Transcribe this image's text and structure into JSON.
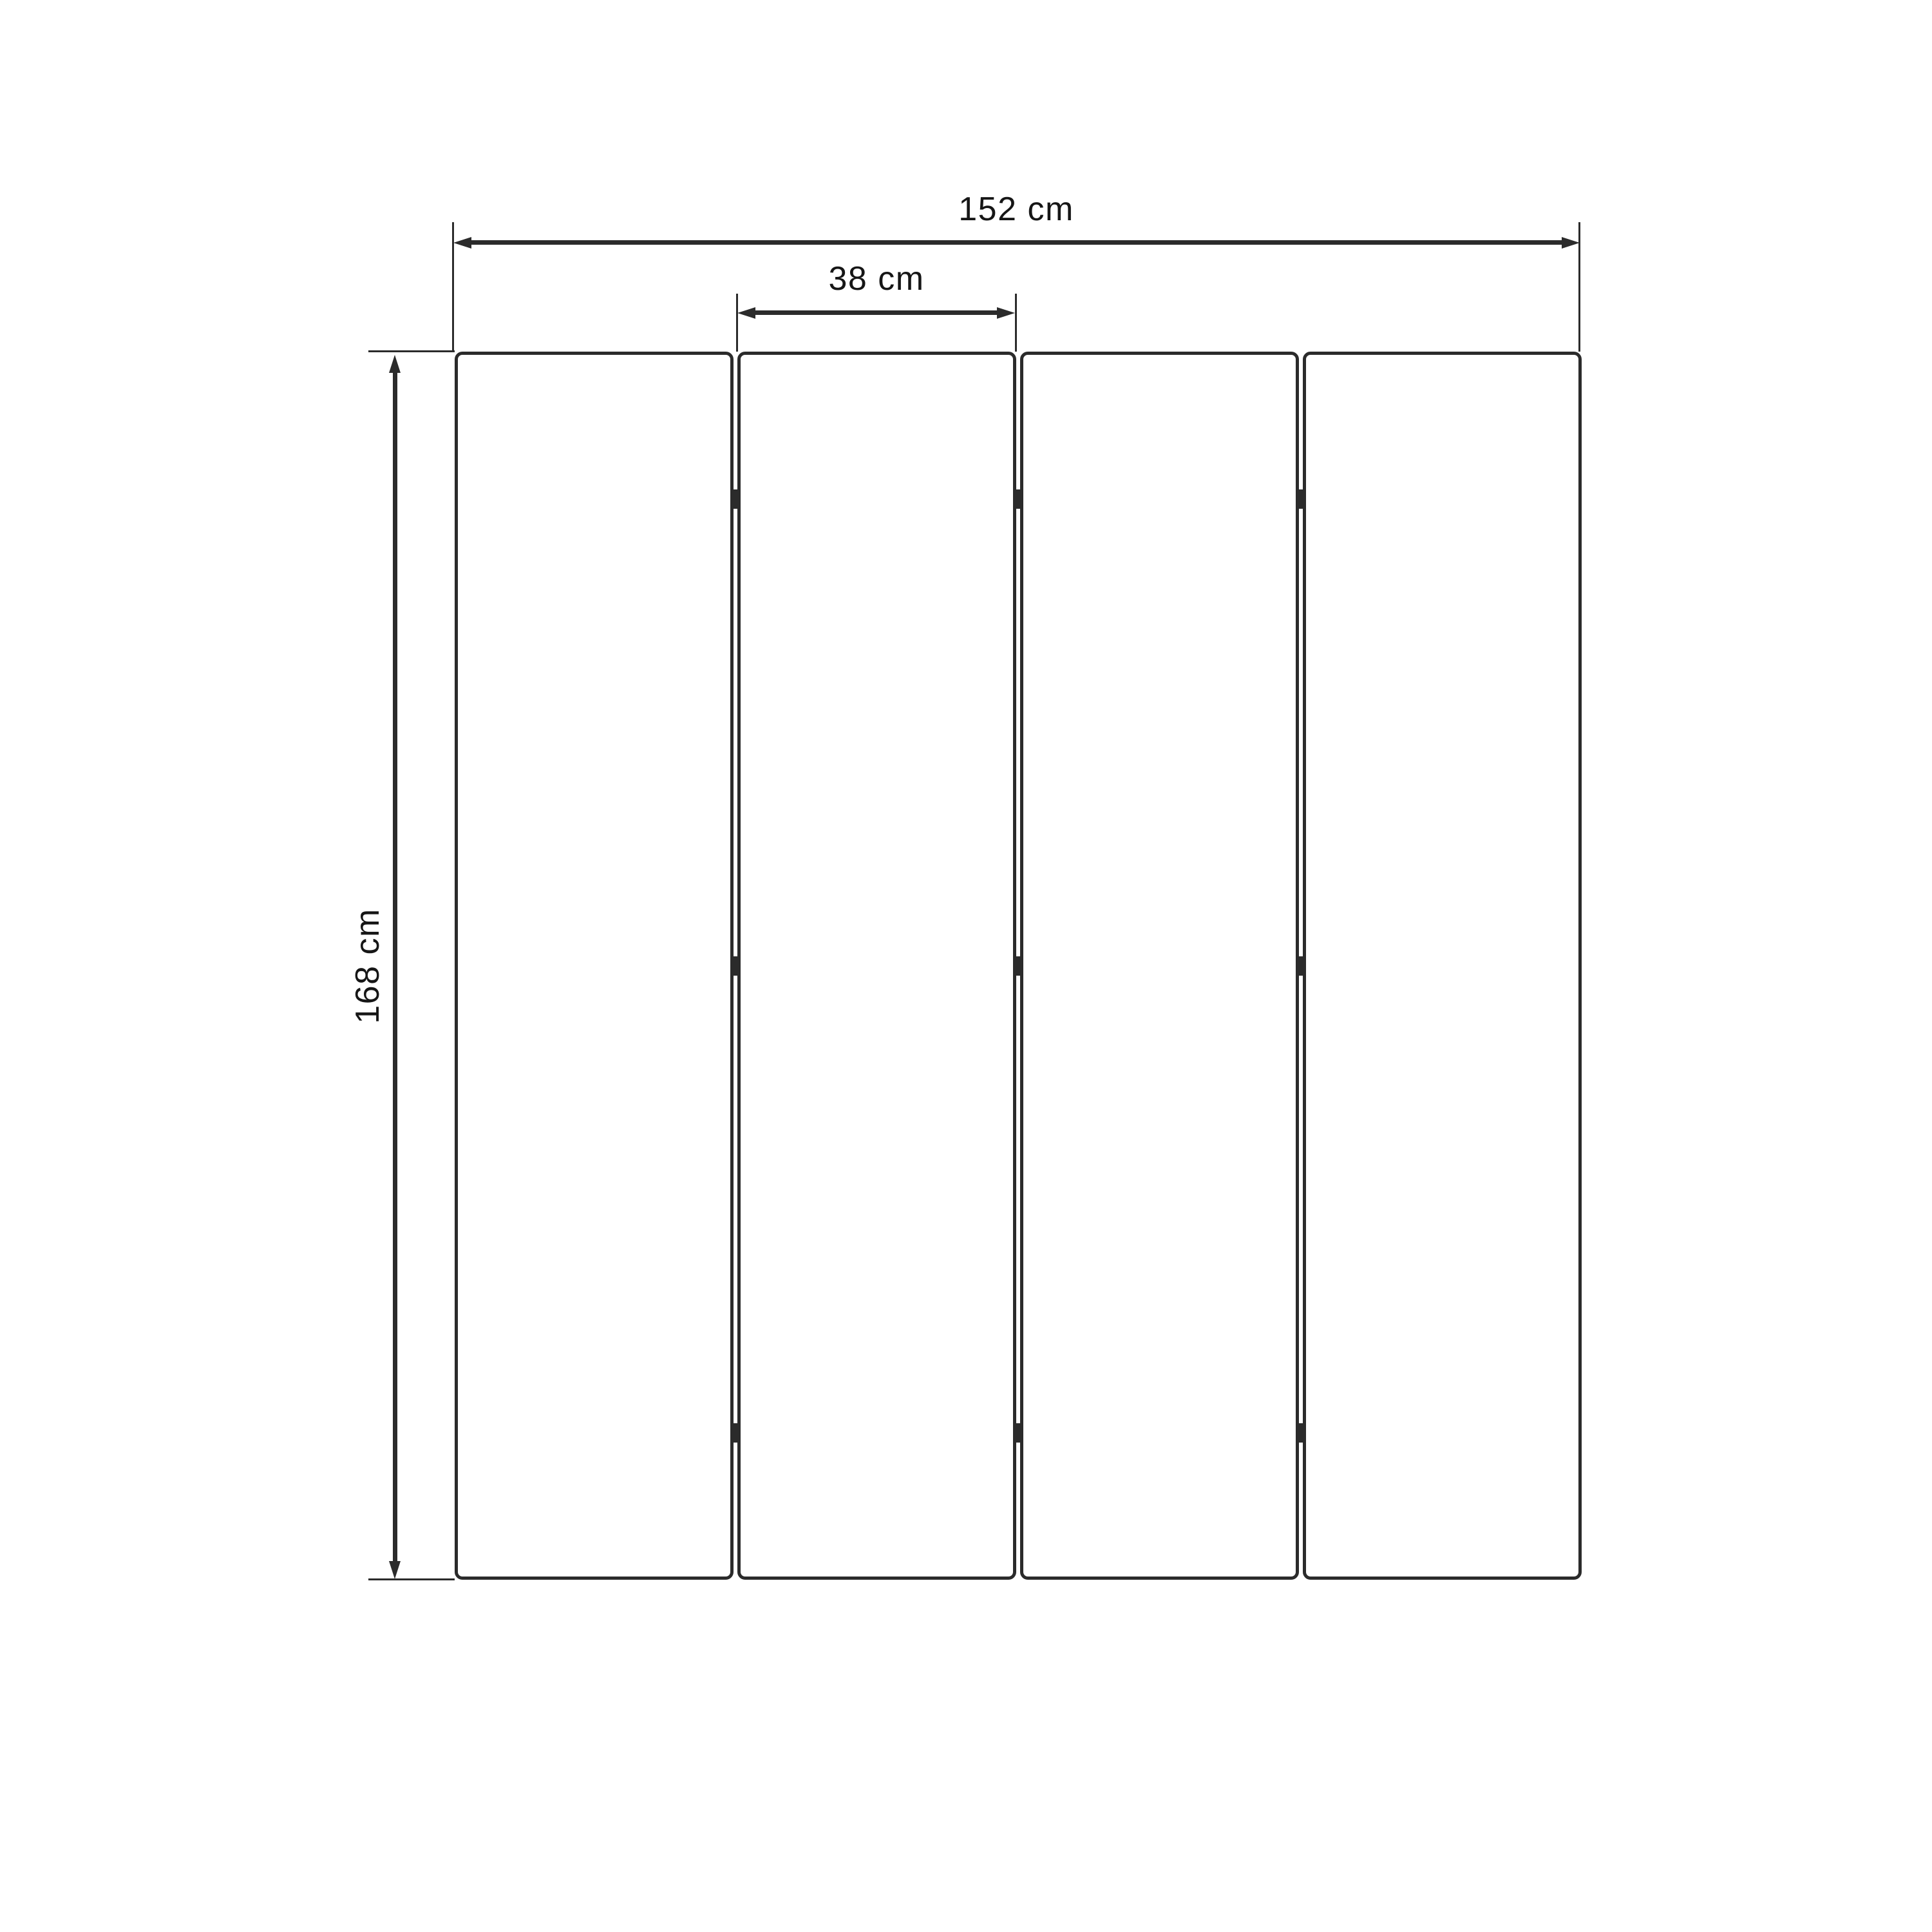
{
  "diagram": {
    "unit": "cm",
    "dimensions": {
      "total_width": {
        "label": "152 cm",
        "value": 152
      },
      "panel_width": {
        "label": "38 cm",
        "value": 38
      },
      "height": {
        "label": "168 cm",
        "value": 168
      }
    },
    "panels": {
      "count": 4,
      "hinge_columns": 3,
      "hinges_per_column": 3
    },
    "colors": {
      "background": "#ffffff",
      "line": "#2b2b2b",
      "text": "#161616"
    }
  }
}
